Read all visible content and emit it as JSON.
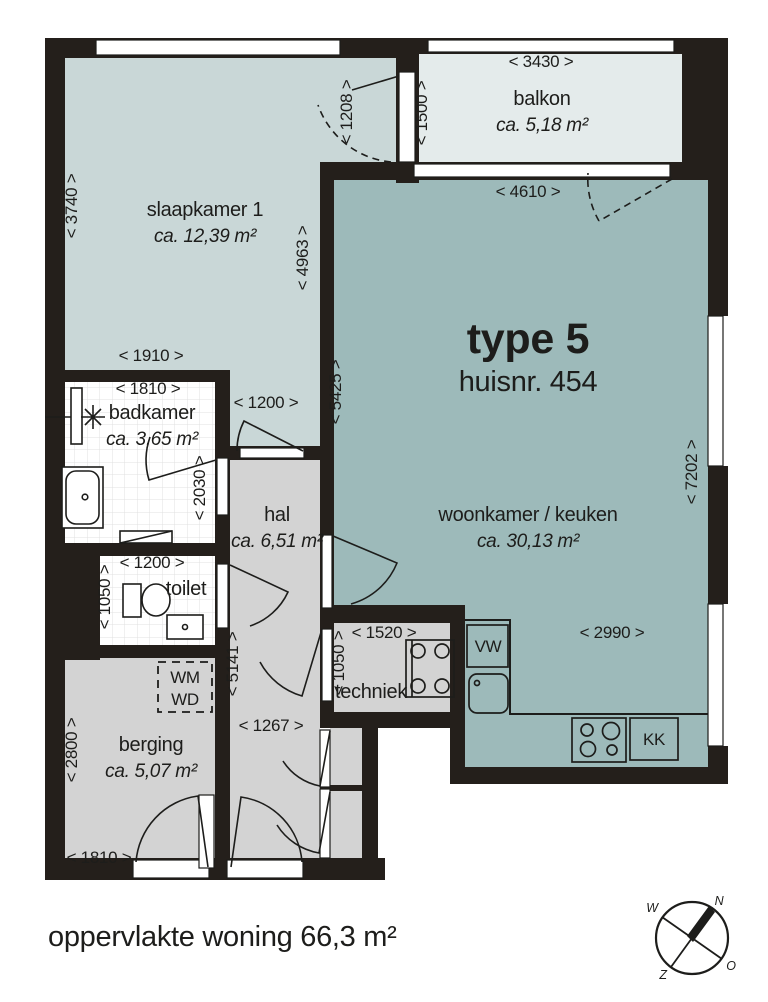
{
  "palette": {
    "wall": "#241f1b",
    "bedroom": "#c9d7d7",
    "living": "#9dbaba",
    "balcony": "#e4ebeb",
    "gray": "#d3d3d3",
    "line": "#1d1d1b",
    "tile": "#e1e1e1"
  },
  "plan": {
    "title": "type 5",
    "subtitle": "huisnr. 454",
    "footer": "oppervlakte woning 66,3 m²",
    "rooms": [
      {
        "name": "slaapkamer 1",
        "area": "ca. 12,39 m²",
        "x": 205,
        "y": 216
      },
      {
        "name": "balkon",
        "area": "ca. 5,18 m²",
        "x": 542,
        "y": 105
      },
      {
        "name": "woonkamer / keuken",
        "area": "ca. 30,13 m²",
        "x": 528,
        "y": 521
      },
      {
        "name": "badkamer",
        "area": "ca. 3,65 m²",
        "x": 152,
        "y": 419
      },
      {
        "name": "toilet",
        "area": null,
        "x": 186,
        "y": 595
      },
      {
        "name": "hal",
        "area": "ca. 6,51 m²",
        "x": 277,
        "y": 521
      },
      {
        "name": "berging",
        "area": "ca. 5,07 m²",
        "x": 151,
        "y": 751
      },
      {
        "name": "techniek",
        "area": null,
        "x": 371,
        "y": 698
      }
    ],
    "dimensions": [
      {
        "label": "< 3740 >",
        "x": 77,
        "y": 206,
        "rot": -90
      },
      {
        "label": "< 1910 >",
        "x": 151,
        "y": 361
      },
      {
        "label": "< 1208 >",
        "x": 352,
        "y": 112,
        "rot": -90
      },
      {
        "label": "< 1500 >",
        "x": 427,
        "y": 113,
        "rot": -90
      },
      {
        "label": "< 3430 >",
        "x": 541,
        "y": 67
      },
      {
        "label": "< 4610 >",
        "x": 528,
        "y": 197
      },
      {
        "label": "< 4963 >",
        "x": 308,
        "y": 258,
        "rot": -90
      },
      {
        "label": "< 5425 >",
        "x": 341,
        "y": 392,
        "rot": -90
      },
      {
        "label": "< 7202 >",
        "x": 697,
        "y": 472,
        "rot": -90
      },
      {
        "label": "< 1810 >",
        "x": 148,
        "y": 394
      },
      {
        "label": "< 1200 >",
        "x": 266,
        "y": 408
      },
      {
        "label": "< 2030 >",
        "x": 205,
        "y": 488,
        "rot": -90
      },
      {
        "label": "< 1200 >",
        "x": 152,
        "y": 568
      },
      {
        "label": "< 1050 >",
        "x": 110,
        "y": 597,
        "rot": -90
      },
      {
        "label": "< 5141 >",
        "x": 238,
        "y": 664,
        "rot": -90
      },
      {
        "label": "< 1267 >",
        "x": 271,
        "y": 731
      },
      {
        "label": "< 2800 >",
        "x": 77,
        "y": 750,
        "rot": -90
      },
      {
        "label": "< 1810 >",
        "x": 99,
        "y": 863
      },
      {
        "label": "< 1520 >",
        "x": 384,
        "y": 638
      },
      {
        "label": "< 1050 >",
        "x": 344,
        "y": 663,
        "rot": -90
      },
      {
        "label": "< 2990 >",
        "x": 612,
        "y": 638
      }
    ],
    "appliances": [
      {
        "label": "VW",
        "x": 488,
        "y": 652
      },
      {
        "label": "KK",
        "x": 654,
        "y": 745
      },
      {
        "label": "WM",
        "x": 185,
        "y": 683
      },
      {
        "label": "WD",
        "x": 185,
        "y": 705
      }
    ],
    "compass": {
      "north": "N",
      "east": "O",
      "south": "Z",
      "west": "W"
    }
  }
}
